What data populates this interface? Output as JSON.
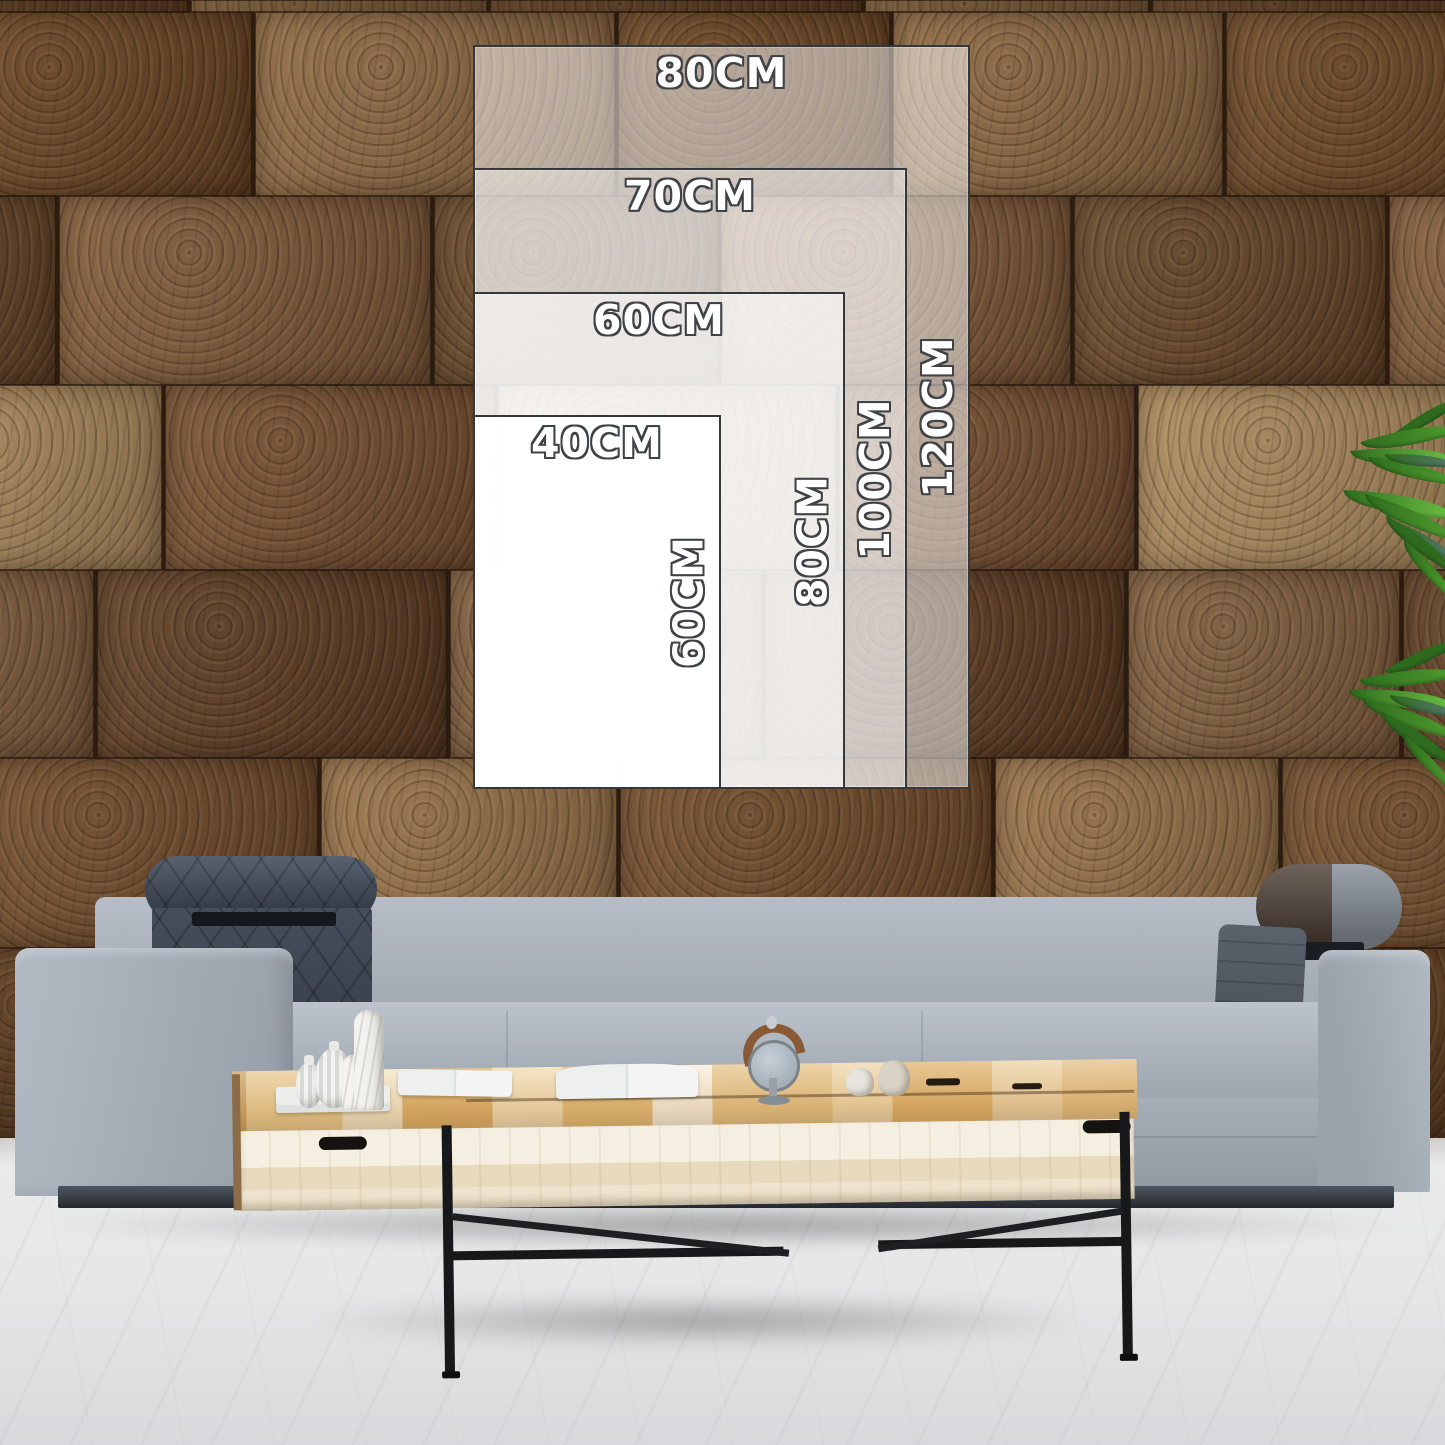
{
  "size_guide": {
    "unit": "CM",
    "sizes": [
      {
        "name": "80 x 120",
        "width_label": "80CM",
        "height_label": "120CM"
      },
      {
        "name": "70 x 100",
        "width_label": "70CM",
        "height_label": "100CM"
      },
      {
        "name": "60 x 80",
        "width_label": "60CM",
        "height_label": "80CM"
      },
      {
        "name": "40 x 60",
        "width_label": "40CM",
        "height_label": "60CM"
      }
    ]
  },
  "palette": {
    "label_fill": "#ffffff",
    "label_outline": "#3f4347",
    "rect_border": "#35383b",
    "wall_gap": "#2c1b0e",
    "headrest": "#454e5a",
    "bolster_brown": "#4e4138",
    "leg_metal": "#17181a",
    "floor": "#e6e7e7",
    "wall_tones": [
      "#6e4b2d",
      "#7d5a3c",
      "#5a3c25",
      "#8a6845",
      "#734f33",
      "#95734c",
      "#62452a",
      "#7f5f42",
      "#684526",
      "#a98a60"
    ],
    "leaf_tones": [
      "#2f6b1e",
      "#4f9c2e",
      "#6cc144",
      "#55786d"
    ]
  }
}
